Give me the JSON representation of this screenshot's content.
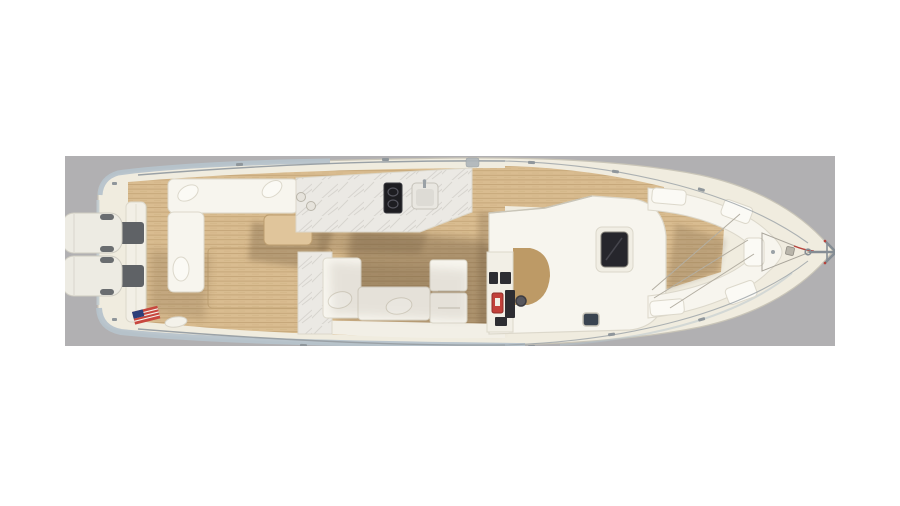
{
  "scene": {
    "description": "Overhead 3D rendering of a dual-console yacht deck plan on a neutral gray backdrop, bow pointing right, twin outboard engines at the stern (left)",
    "engine_count": 2,
    "parts": [
      "image-backdrop",
      "hull-deck",
      "port-hull-side-band",
      "starboard-hull-side-band",
      "cockpit-teak-deck",
      "side-deck-teak",
      "bow-teak-deck",
      "swim-platform-seam",
      "transom-wall",
      "outboard-engine-port",
      "outboard-engine-starboard",
      "engine-mounts",
      "aft-port-bench",
      "bench-pillows",
      "aft-chaise",
      "chaise-towel",
      "cockpit-table",
      "lazarette-hatch-seam",
      "galley-counter",
      "cooktop",
      "galley-sink",
      "counter-cupholders",
      "head-compartment-top",
      "dinette-left-seat",
      "dinette-bench",
      "dinette-cabinet",
      "dinette-pillows",
      "hardtop-roof",
      "sunroof-hatch",
      "windshield-seam",
      "helm-console",
      "helm-screens",
      "fire-extinguisher",
      "electronics-panel",
      "steering-wheel",
      "companionway-opening",
      "deck-hatch",
      "bow-seating-ring",
      "bow-cushions",
      "bow-cover-lines",
      "anchor-locker-outline",
      "windlass-fittings",
      "anchor",
      "mooring-line",
      "bow-rails",
      "stern-rails",
      "cleat-fittings",
      "boarding-gate-hardware",
      "american-flag",
      "stern-fender"
    ],
    "colors": {
      "page_bg": "#ffffff",
      "backdrop": "#b1b0b2",
      "hull": "#f0ecdf",
      "hull_edge": "#c9c5b8",
      "hull_side_blue": "#b6c3cb",
      "teak": "#d9bc90",
      "teak_line": "#c5a678",
      "teak_trim": "#bb9d6f",
      "table_teak": "#e0c59b",
      "furniture": "#f7f5ee",
      "furniture_edge": "#dcd8cb",
      "pillow": "#fbfaf5",
      "marble": "#ebe9e4",
      "marble_vein": "#cfccc7",
      "rail": "#9aa1a6",
      "sunroof": "#26262c",
      "cooktop": "#1d1d21",
      "hatch_dark": "#3a4450",
      "companionway_tan": "#bd9a66",
      "console_dark": "#2d2d32",
      "extinguisher_red": "#c2403a",
      "flag_red": "#c8473f",
      "flag_blue": "#2e3f7a",
      "anchor_gray": "#858d94",
      "engine_mount": "#5f6266",
      "shadow": "#53402a"
    }
  }
}
